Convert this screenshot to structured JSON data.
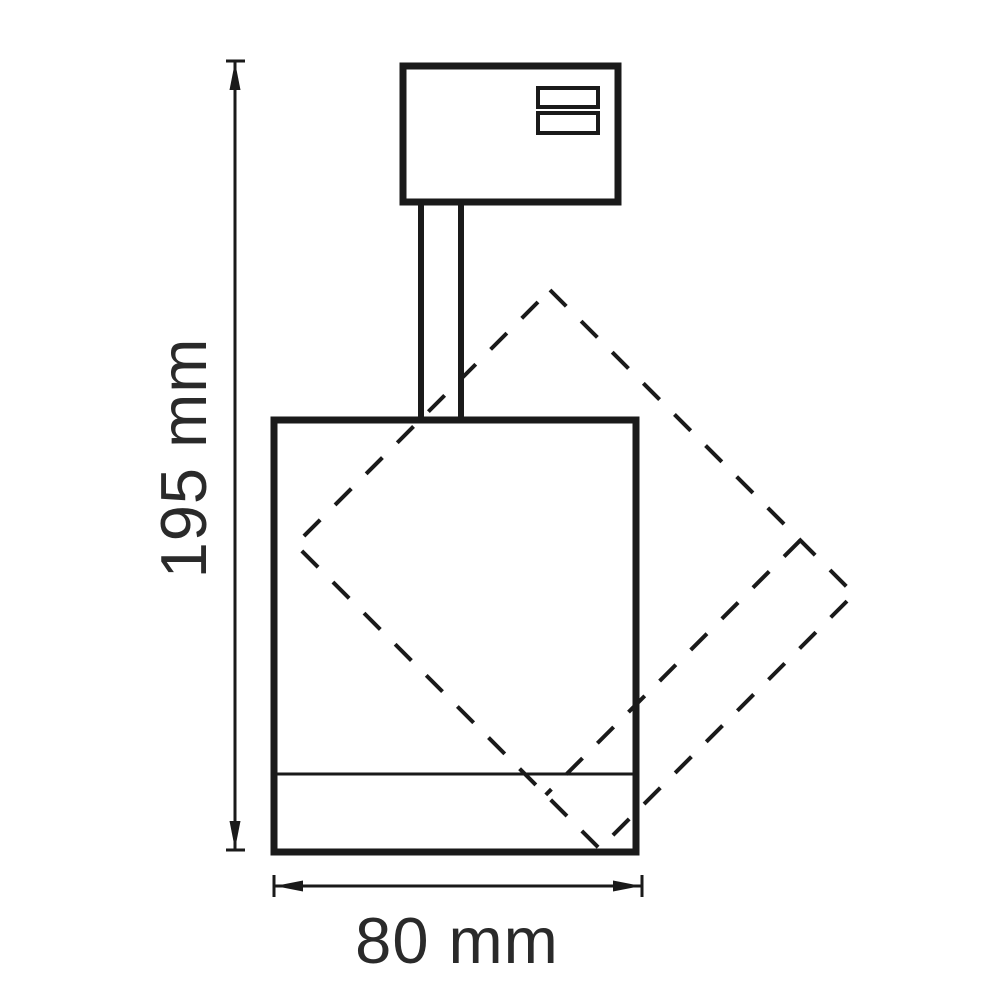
{
  "title": "Track spotlight dimensional drawing",
  "theme": {
    "background": "#ffffff",
    "line_color": "#1a1a1a",
    "text_color": "#2a2a2a"
  },
  "diagram": {
    "type": "technical-dimension-drawing",
    "parts": [
      "track-adapter-box",
      "adapter-contact-slots",
      "stem",
      "lamp-body",
      "lamp-body-rotated-45deg-dashed"
    ],
    "dimensions": {
      "height": {
        "label": "195 mm",
        "orientation": "vertical"
      },
      "width": {
        "label": "80 mm",
        "orientation": "horizontal"
      }
    }
  }
}
